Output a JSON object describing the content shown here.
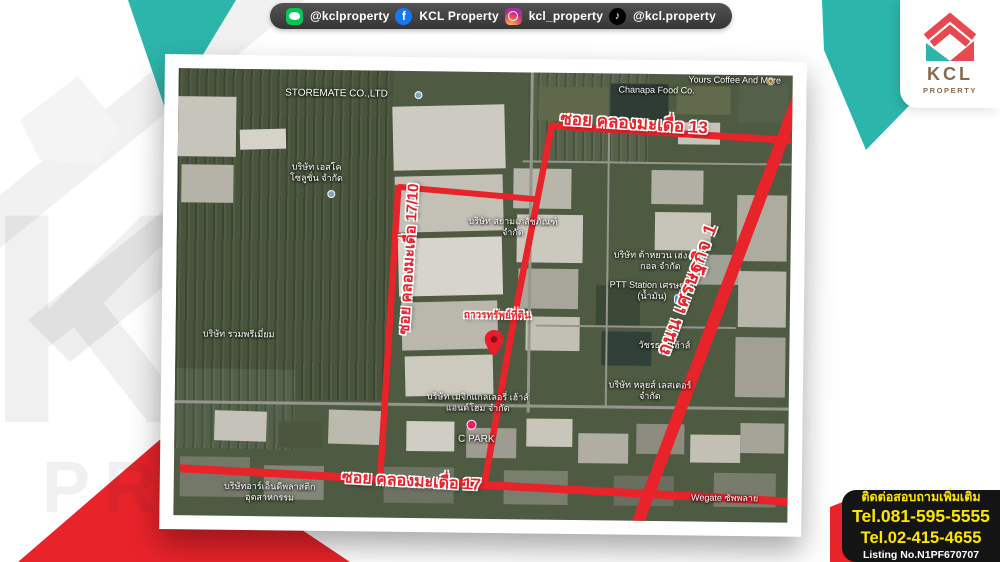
{
  "social_bar": {
    "items": [
      {
        "platform": "line",
        "handle": "@kclproperty"
      },
      {
        "platform": "facebook",
        "handle": "KCL Property",
        "glyph": "f"
      },
      {
        "platform": "instagram",
        "handle": "kcl_property"
      },
      {
        "platform": "tiktok",
        "handle": "@kcl.property",
        "glyph": "♪"
      }
    ]
  },
  "logo": {
    "name": "KCL",
    "tagline": "PROPERTY"
  },
  "watermark": {
    "line1": "KCL",
    "line2": "PROPERTY"
  },
  "map": {
    "road_labels": {
      "top": "ซอย คลองมะเดื่อ 13",
      "left": "ซอย คลองมะเดื่อ 17/10",
      "right": "ถนน เศรษฐกิจ 1",
      "bottom": "ซอย คลองมะเดื่อ 17"
    },
    "property_pin_label": "ถาวรทรัพย์ที่ดิน",
    "places": [
      {
        "text": "STOREMATE CO.,LTD"
      },
      {
        "text": "Chanapa Food Co."
      },
      {
        "text": "Yours Coffee And More"
      },
      {
        "text": "บริษัท เอสโค โซลูชั่น จำกัด"
      },
      {
        "text": "บริษัท สยามเภสัชภัณฑ์ จำกัด"
      },
      {
        "text": "บริษัท ต้าหยวน เฮ่ง แมท กอล จำกัด"
      },
      {
        "text": "PTT Station เศรษฐกิจ (น้ำมัน)"
      },
      {
        "text": "วัชรธานีเฮ้าส์"
      },
      {
        "text": "บริษัท หลุยส์ เลสเตอร์ จำกัด"
      },
      {
        "text": "บริษัท เมจิกแกลเลอรี่ เฮ้าส์แอนด์โฮม จำกัด"
      },
      {
        "text": "C PARK"
      },
      {
        "text": "บริษัท รวมพรีเมี่ยม"
      },
      {
        "text": "บริษัทอาร์เอ็นดีพลาสติก อุตสาหกรรม"
      },
      {
        "text": "Wegate ซัพพลาย"
      }
    ]
  },
  "contact": {
    "heading": "ติดต่อสอบถามเพิ่มเติม",
    "phone1": "Tel.081-595-5555",
    "phone2": "Tel.02-415-4655",
    "listing": "Listing No.N1PF670707"
  },
  "colors": {
    "accent_teal": "#2cb5aa",
    "accent_red": "#e8232a",
    "highlight_yellow": "#ffe600",
    "road_red": "#e8232a"
  }
}
